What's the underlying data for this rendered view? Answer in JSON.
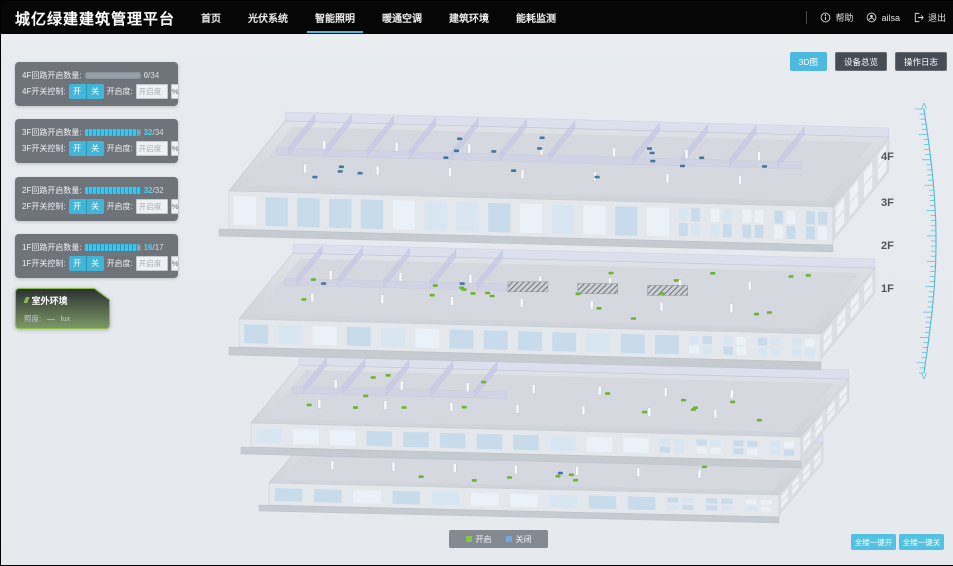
{
  "header": {
    "title": "城亿绿建建筑管理平台",
    "nav": [
      {
        "label": "首页",
        "active": false
      },
      {
        "label": "光伏系统",
        "active": false
      },
      {
        "label": "智能照明",
        "active": true
      },
      {
        "label": "暖通空调",
        "active": false
      },
      {
        "label": "建筑环境",
        "active": false
      },
      {
        "label": "能耗监测",
        "active": false
      }
    ],
    "help_label": "帮助",
    "username": "ailsa",
    "logout_label": "退出"
  },
  "view_buttons": [
    {
      "label": "3D图",
      "active": true
    },
    {
      "label": "设备总览",
      "active": false
    },
    {
      "label": "操作日志",
      "active": false
    }
  ],
  "floor_panels": [
    {
      "circuit_label": "4F回路开启数量:",
      "count": "0",
      "total_suffix": "/34",
      "percent_on": 0,
      "count_color": "#c9ced6",
      "switch_label": "4F开关控制:",
      "on_label": "开",
      "off_label": "关",
      "dim_label": "开启度:",
      "dim_placeholder": "开启度",
      "unit_label": "%"
    },
    {
      "circuit_label": "3F回路开启数量:",
      "count": "32",
      "total_suffix": "/34",
      "percent_on": 94,
      "count_color": "#4fd2f2",
      "switch_label": "3F开关控制:",
      "on_label": "开",
      "off_label": "关",
      "dim_label": "开启度:",
      "dim_placeholder": "开启度",
      "unit_label": "%"
    },
    {
      "circuit_label": "2F回路开启数量:",
      "count": "32",
      "total_suffix": "/32",
      "percent_on": 100,
      "count_color": "#4fd2f2",
      "switch_label": "2F开关控制:",
      "on_label": "开",
      "off_label": "关",
      "dim_label": "开启度:",
      "dim_placeholder": "开启度",
      "unit_label": "%"
    },
    {
      "circuit_label": "1F回路开启数量:",
      "count": "16",
      "total_suffix": "/17",
      "percent_on": 94,
      "count_color": "#4fd2f2",
      "switch_label": "1F开关控制:",
      "on_label": "开",
      "off_label": "关",
      "dim_label": "开启度:",
      "dim_placeholder": "开启度",
      "unit_label": "%"
    }
  ],
  "outdoor": {
    "title": "室外环境",
    "metric_label": "照度:",
    "metric_value": "—",
    "metric_unit": "lux"
  },
  "floor_tags": [
    "4F",
    "3F",
    "2F",
    "1F"
  ],
  "legend": {
    "items": [
      {
        "label": "开启",
        "color": "#8bc34a"
      },
      {
        "label": "关闭",
        "color": "#74a9dd"
      }
    ]
  },
  "global_buttons": [
    {
      "label": "全楼一键开"
    },
    {
      "label": "全楼一键关"
    }
  ],
  "colors": {
    "accent": "#45b8dc",
    "nav_underline": "#45b8dc",
    "marker_on": "#6cb32e",
    "marker_off": "#44789e"
  },
  "building": {
    "marker_counts": [
      {
        "floor": "1F",
        "on": 11,
        "off": 1
      },
      {
        "floor": "2F",
        "on": 15,
        "off": 0
      },
      {
        "floor": "3F",
        "on": 20,
        "off": 2
      },
      {
        "floor": "4F",
        "on": 0,
        "off": 18
      }
    ]
  }
}
